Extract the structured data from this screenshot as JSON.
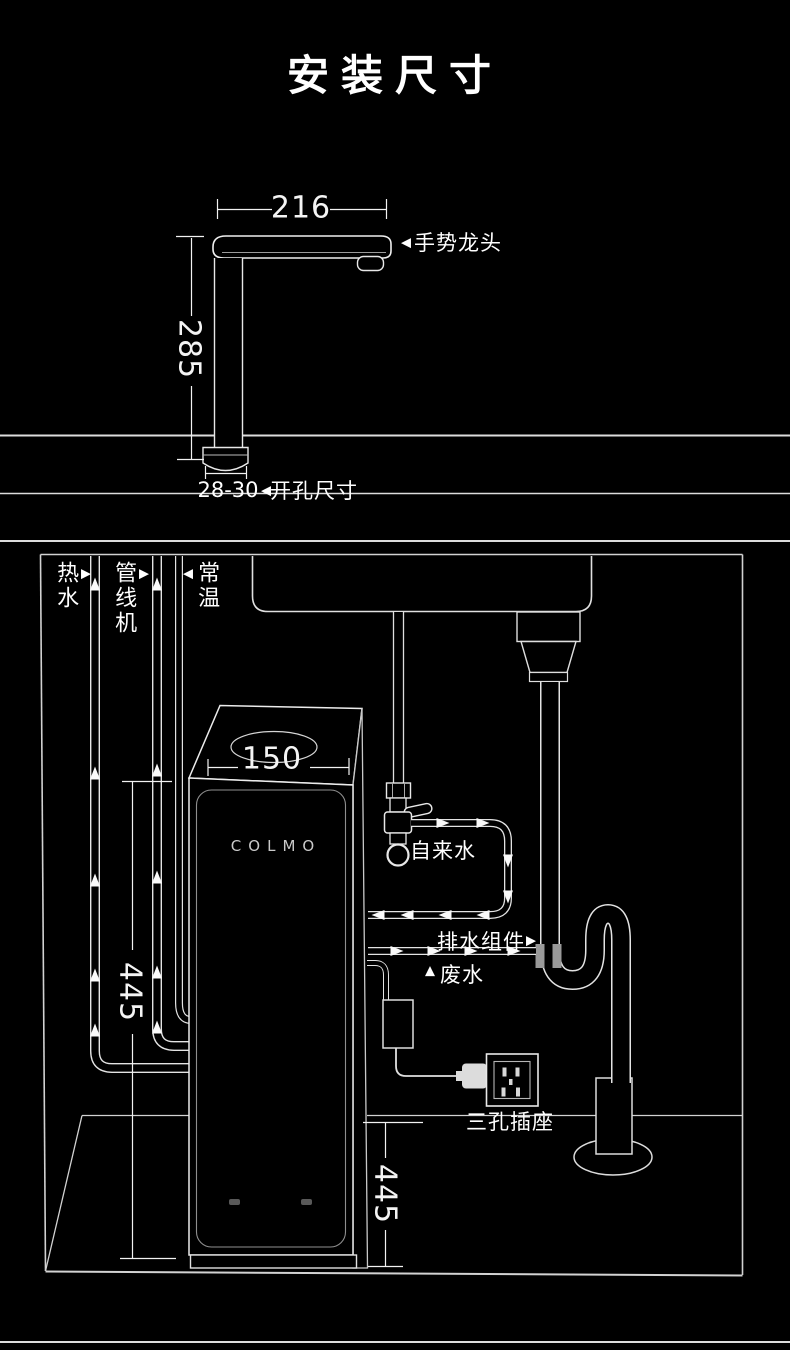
{
  "title": "安装尺寸",
  "faucet_view": {
    "width_dim": "216",
    "height_dim": "285",
    "label_arrow": "◀",
    "faucet_label": "手势龙头",
    "hole_dim": "28-30",
    "hole_arrow": "◀",
    "hole_label": "开孔尺寸"
  },
  "cabinet_view": {
    "hot_water": {
      "label": "热水",
      "arrow": "▶"
    },
    "pipeline_machine": {
      "label": "管线机",
      "arrow": "▶"
    },
    "ambient": {
      "label": "常温",
      "arrow": "◀"
    },
    "purifier": {
      "brand": "COLMO",
      "top_dim": "150",
      "height_dim": "445"
    },
    "tap_water_label": "自来水",
    "drain_kit": {
      "label": "排水组件",
      "arrow": "▶"
    },
    "waste": {
      "label": "废水",
      "arrow": "▲"
    },
    "socket_label": "三孔插座",
    "floor_depth_dim": "445"
  },
  "colors": {
    "background": "#000000",
    "line": "#e9e9e9",
    "text": "#ffffff",
    "fitting_gray": "#999999"
  }
}
